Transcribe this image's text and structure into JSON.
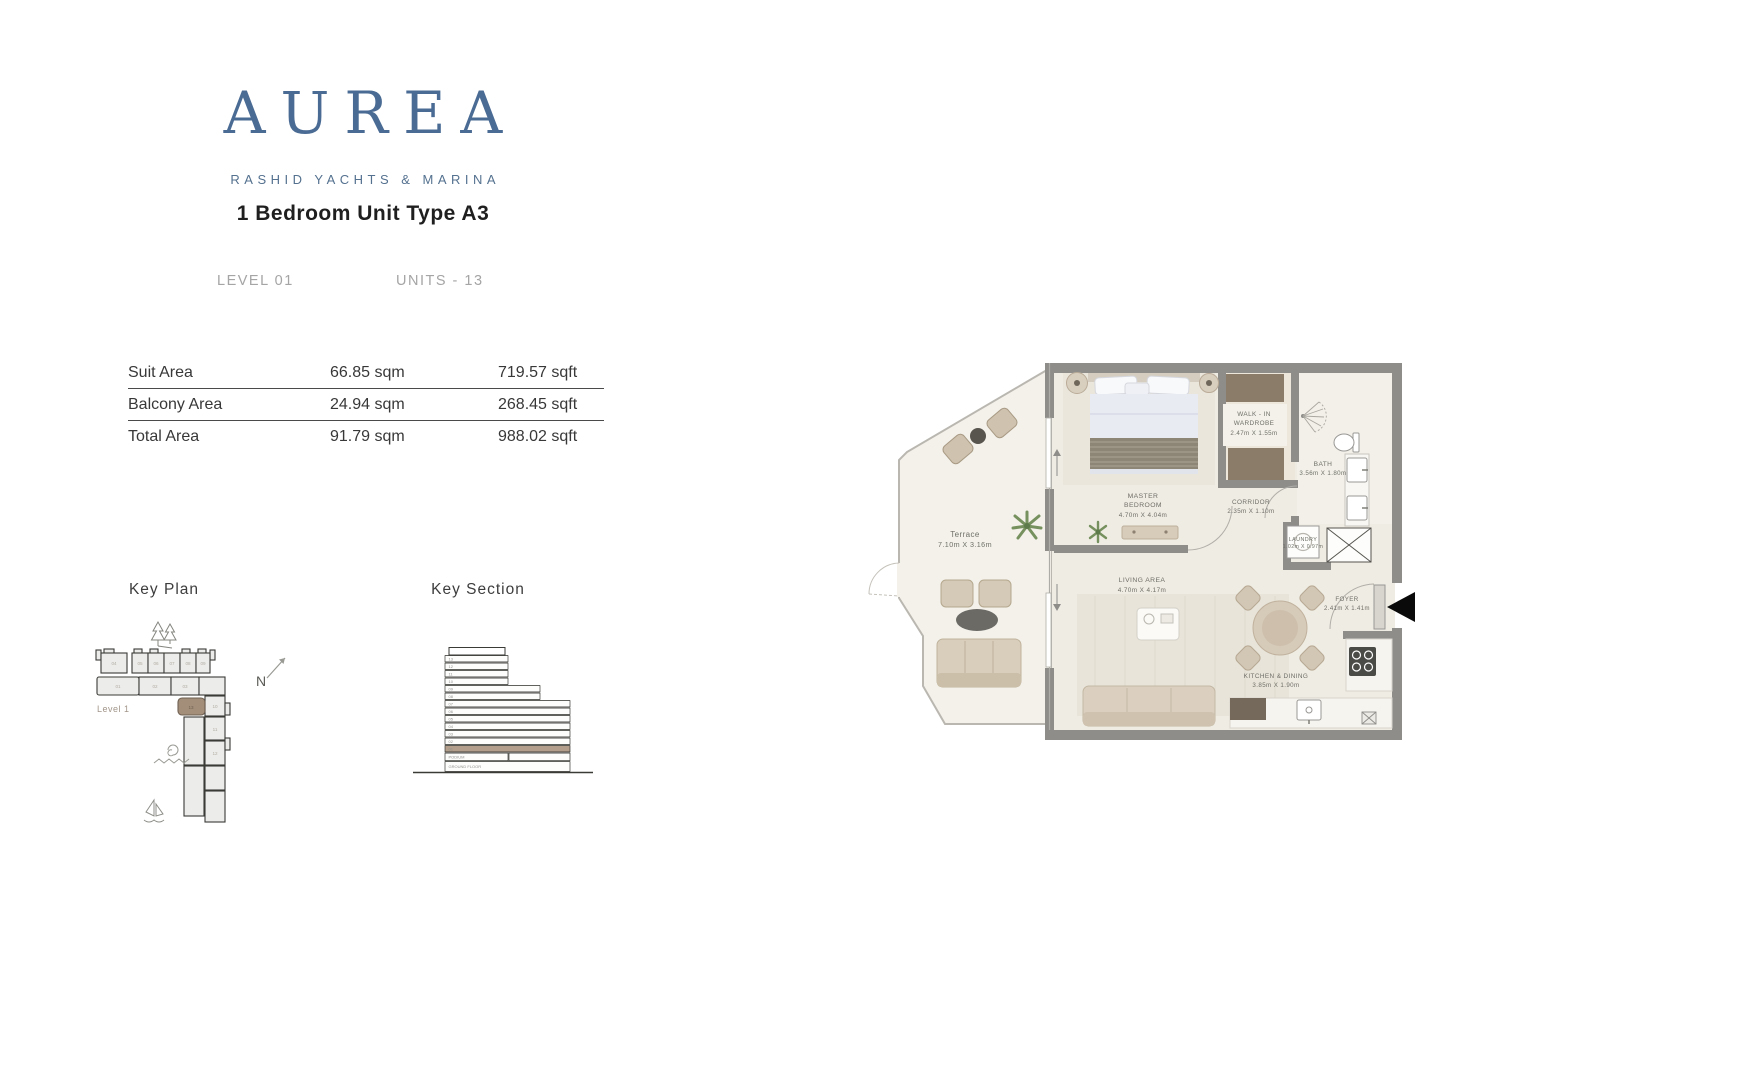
{
  "brand": {
    "logo": "AUREA",
    "tagline": "RASHID YACHTS & MARINA"
  },
  "header": {
    "title": "1 Bedroom Unit Type A3",
    "level": "LEVEL 01",
    "units": "UNITS - 13"
  },
  "area_table": {
    "rows": [
      {
        "label": "Suit Area",
        "sqm": "66.85 sqm",
        "sqft": "719.57 sqft"
      },
      {
        "label": "Balcony Area",
        "sqm": "24.94 sqm",
        "sqft": "268.45 sqft"
      },
      {
        "label": "Total Area",
        "sqm": "91.79 sqm",
        "sqft": "988.02 sqft"
      }
    ]
  },
  "key_plan": {
    "title": "Key Plan",
    "level_label": "Level 1",
    "north_label": "N",
    "units": {
      "top_row": [
        "04",
        "05",
        "06",
        "07",
        "08",
        "09"
      ],
      "second_row": [
        "01",
        "02",
        "03"
      ],
      "right_column": [
        "10",
        "11",
        "12"
      ],
      "highlighted": "13"
    }
  },
  "key_section": {
    "title": "Key Section",
    "floors": [
      "13",
      "12",
      "11",
      "10",
      "09",
      "08",
      "07",
      "06",
      "05",
      "04",
      "03",
      "02",
      "01",
      "PODIUM",
      "GROUND FLOOR"
    ],
    "highlighted_floor": "01"
  },
  "floorplan": {
    "rooms": [
      {
        "name_lines": [
          "Terrace"
        ],
        "dims": "7.10m X 3.16m"
      },
      {
        "name_lines": [
          "MASTER",
          "BEDROOM"
        ],
        "dims": "4.70m X 4.04m"
      },
      {
        "name_lines": [
          "WALK - IN",
          "WARDROBE"
        ],
        "dims": "2.47m X 1.55m"
      },
      {
        "name_lines": [
          "BATH"
        ],
        "dims": "3.56m X 1.80m"
      },
      {
        "name_lines": [
          "CORRIDOR"
        ],
        "dims": "2.35m X 1.10m"
      },
      {
        "name_lines": [
          "LAUNDRY"
        ],
        "dims": "1.02m X 0.97m"
      },
      {
        "name_lines": [
          "LIVING AREA"
        ],
        "dims": "4.70m X 4.17m"
      },
      {
        "name_lines": [
          "FOYER"
        ],
        "dims": "2.41m X 1.41m"
      },
      {
        "name_lines": [
          "KITCHEN & DINING"
        ],
        "dims": "3.85m X 1.90m"
      }
    ]
  },
  "colors": {
    "brand_blue": "#4a6b94",
    "highlight_brown": "#a38e79",
    "wall_gray": "#8e8d8a",
    "floor_cream": "#efece3"
  }
}
